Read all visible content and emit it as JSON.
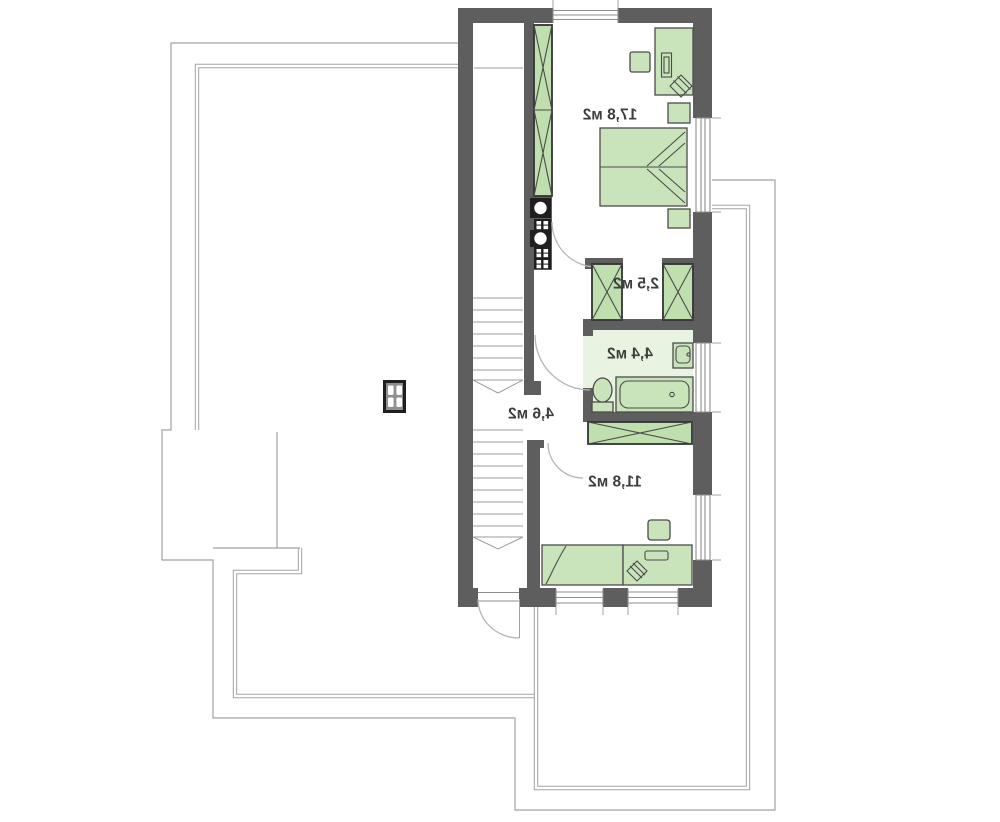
{
  "plan": {
    "kind": "floor-plan",
    "labels_mirrored": true,
    "rooms": [
      {
        "name": "bedroom-large",
        "area_label": "17,8 м2"
      },
      {
        "name": "closet",
        "area_label": "2,5 м2"
      },
      {
        "name": "bathroom",
        "area_label": "4,4 м2"
      },
      {
        "name": "hallway-stairs",
        "area_label": "4,6 м2"
      },
      {
        "name": "bedroom-small",
        "area_label": "11,8 м2"
      }
    ],
    "colors": {
      "wall": "#5e5e5e",
      "outline": "#a2a2a2",
      "glazing": "#8c8c8c",
      "stair_line": "#9d9d9d",
      "door_arc": "#b5b5b5",
      "furniture_fill": "#c9e4ba",
      "furniture_stroke": "#4b4b4b",
      "wardrobe_fill": "#bfdfae",
      "wardrobe_stroke": "#333333",
      "bath_floor": "#e9f3e1",
      "shaft_block": "#1f1f1f",
      "label": "#3e3e3e",
      "background": "#ffffff"
    }
  }
}
